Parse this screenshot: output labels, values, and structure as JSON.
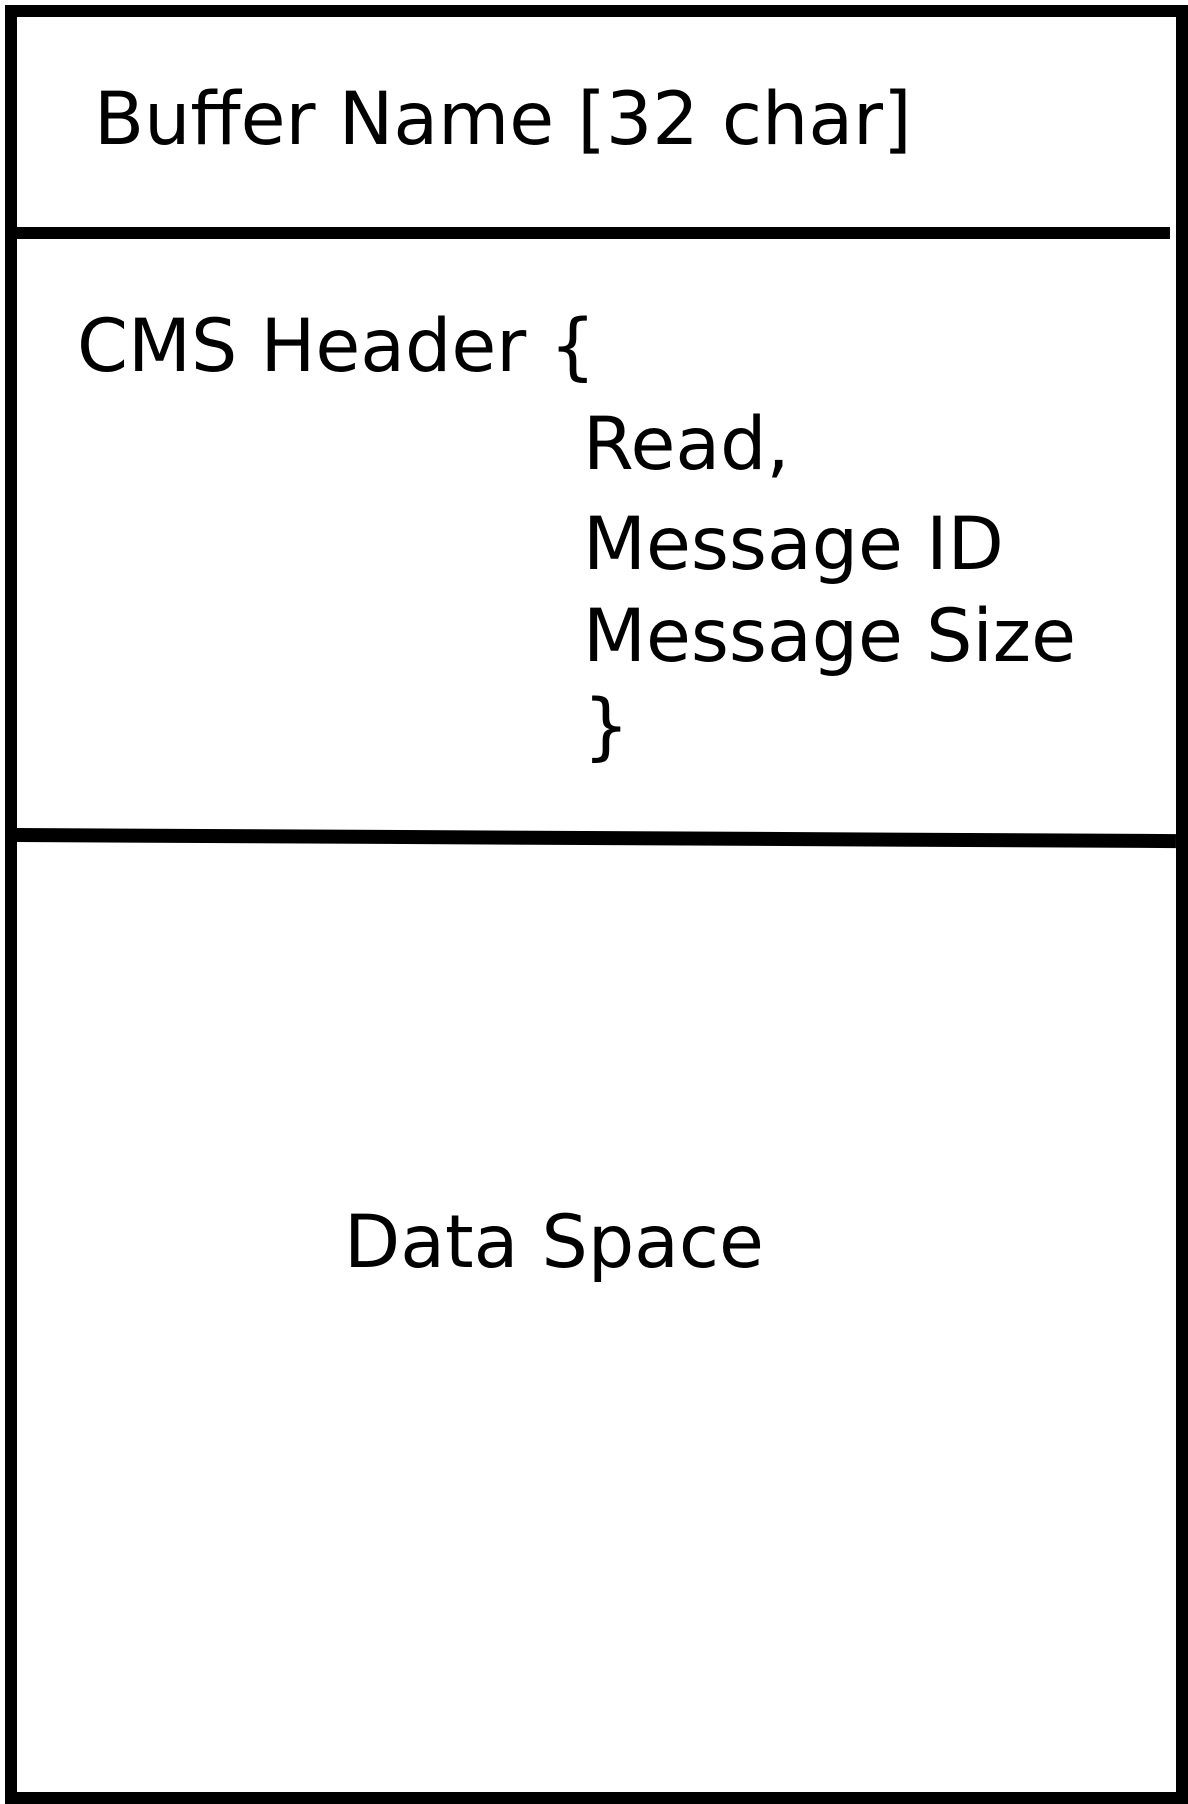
{
  "diagram": {
    "sections": {
      "buffer_name": {
        "label": "Buffer Name [32 char]"
      },
      "cms_header": {
        "opening": "CMS Header {",
        "fields": [
          "Read,",
          "Message ID",
          "Message Size"
        ],
        "closing": "}"
      },
      "data_space": {
        "label": "Data Space"
      }
    },
    "colors": {
      "line": "#000000",
      "background": "#ffffff"
    }
  }
}
